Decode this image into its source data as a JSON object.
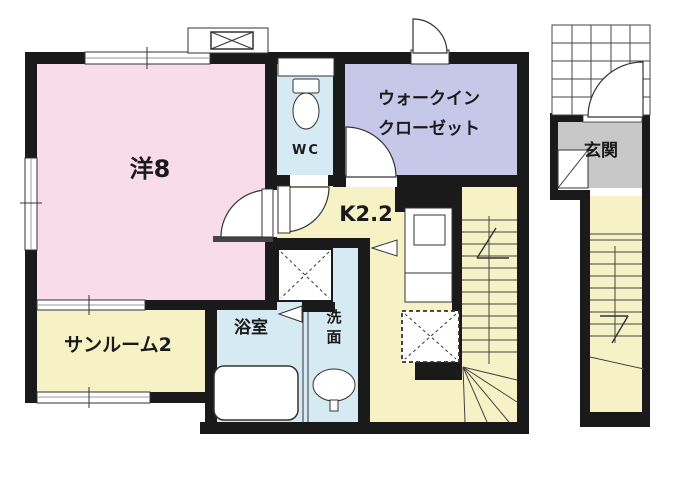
{
  "rooms": {
    "western_room": {
      "label": "洋8",
      "color": "#f8dce8"
    },
    "sunroom": {
      "label": "サンルーム2",
      "color": "#f6f2c6"
    },
    "wc": {
      "label": "WC",
      "color": "#d6eaf4"
    },
    "walk_in_closet": {
      "label_line1": "ウォークイン",
      "label_line2": "クローゼット",
      "color": "#c7c7ea"
    },
    "kitchen": {
      "label": "K2.2",
      "color": "#f6f2c6"
    },
    "pipe_space": {
      "label": "PS"
    },
    "bathroom": {
      "label": "浴室",
      "color": "#d6eaf4"
    },
    "washroom": {
      "label": "洗面",
      "color": "#d6eaf4"
    },
    "entrance": {
      "label": "玄関",
      "color": "#c8c8c8"
    },
    "stairs": {
      "color": "#f6f2c6"
    }
  },
  "fixtures": {
    "icons": [
      "toilet-icon",
      "bathtub-icon",
      "wash-basin-icon",
      "kitchen-sink-icon",
      "washing-machine-space-icon",
      "refrigerator-space-icon",
      "vent-box-icon",
      "stair-up-arrow-icon",
      "stair-down-arrow-icon",
      "porch-grid-icon",
      "door-swing-arc-icon",
      "folding-door-triangle-icon",
      "window-icon"
    ]
  },
  "colors": {
    "wall": "#1a1a1a",
    "outline": "#333333",
    "window_mid": "#999999"
  }
}
